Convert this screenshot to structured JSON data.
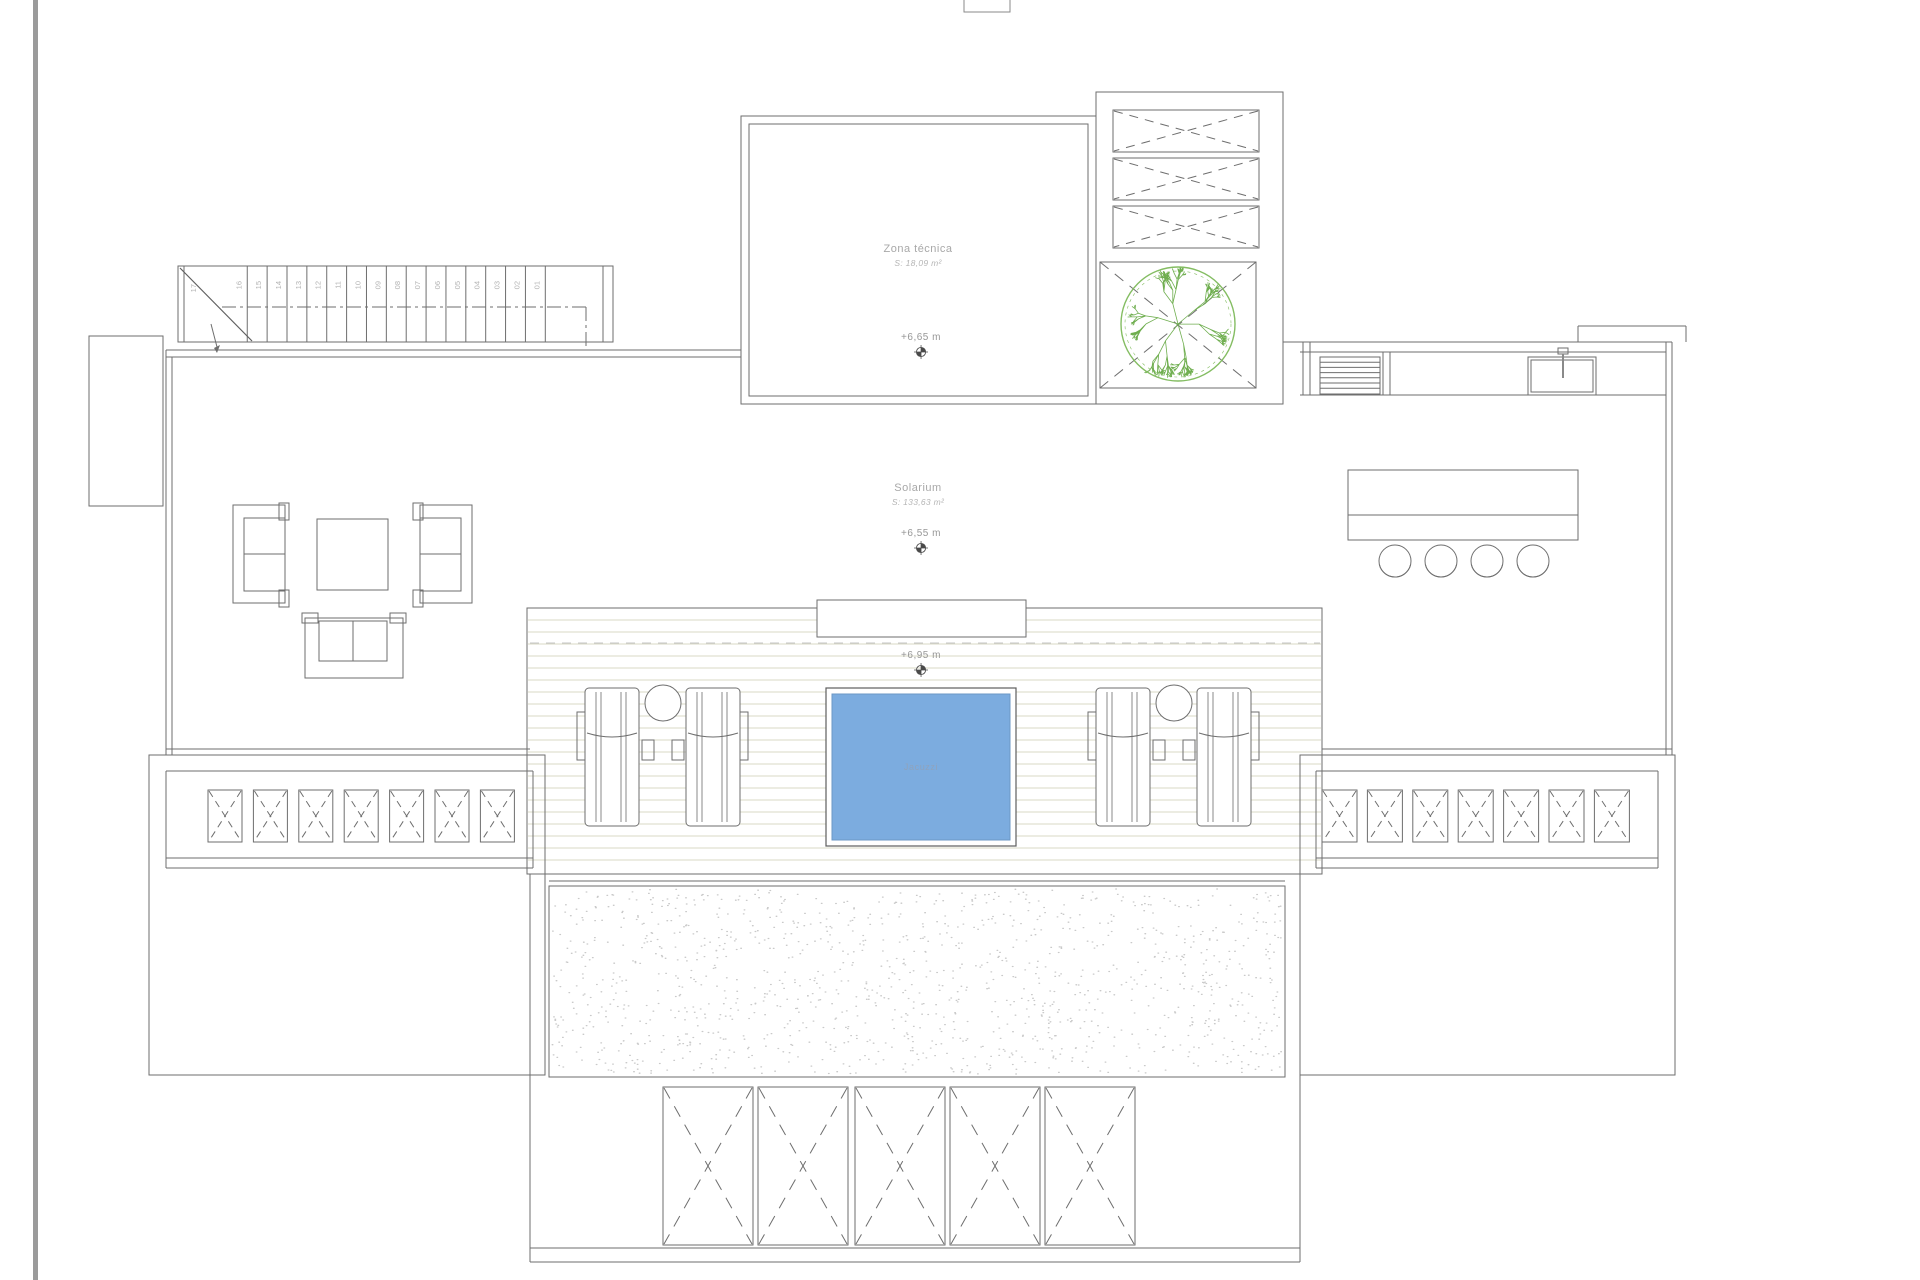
{
  "plan": {
    "rooms": {
      "zona_tecnica": {
        "name": "Zona técnica",
        "area": "S: 18,09 m²",
        "level": "+6,65 m"
      },
      "solarium": {
        "name": "Solarium",
        "area": "S: 133,63 m²",
        "level": "+6,55 m"
      },
      "deck": {
        "level": "+6,95 m"
      },
      "jacuzzi": {
        "name": "Jacuzzi"
      }
    },
    "stairs": {
      "treads": [
        "01",
        "02",
        "03",
        "04",
        "05",
        "06",
        "07",
        "08",
        "09",
        "10",
        "11",
        "12",
        "13",
        "14",
        "15",
        "16"
      ],
      "top_tread": "17"
    },
    "counts": {
      "roof_vents": 3,
      "skylights_left": 7,
      "skylights_right": 7,
      "pergola_panels": 5,
      "bar_stools": 4,
      "grill_slats": 6
    },
    "colors": {
      "line": "#6e6e6e",
      "light_line": "#9a9a9a",
      "dash": "#a8a8a8",
      "deck_plank": "#d9d9c6",
      "gravel_dot": "#c9c9c9",
      "jacuzzi_fill": "#7cacdf",
      "jacuzzi_edge": "#6b97c6",
      "tree_green": "#6fae4f",
      "tree_ring": "#84bd62",
      "page_edge": "#9b9b9b"
    }
  }
}
